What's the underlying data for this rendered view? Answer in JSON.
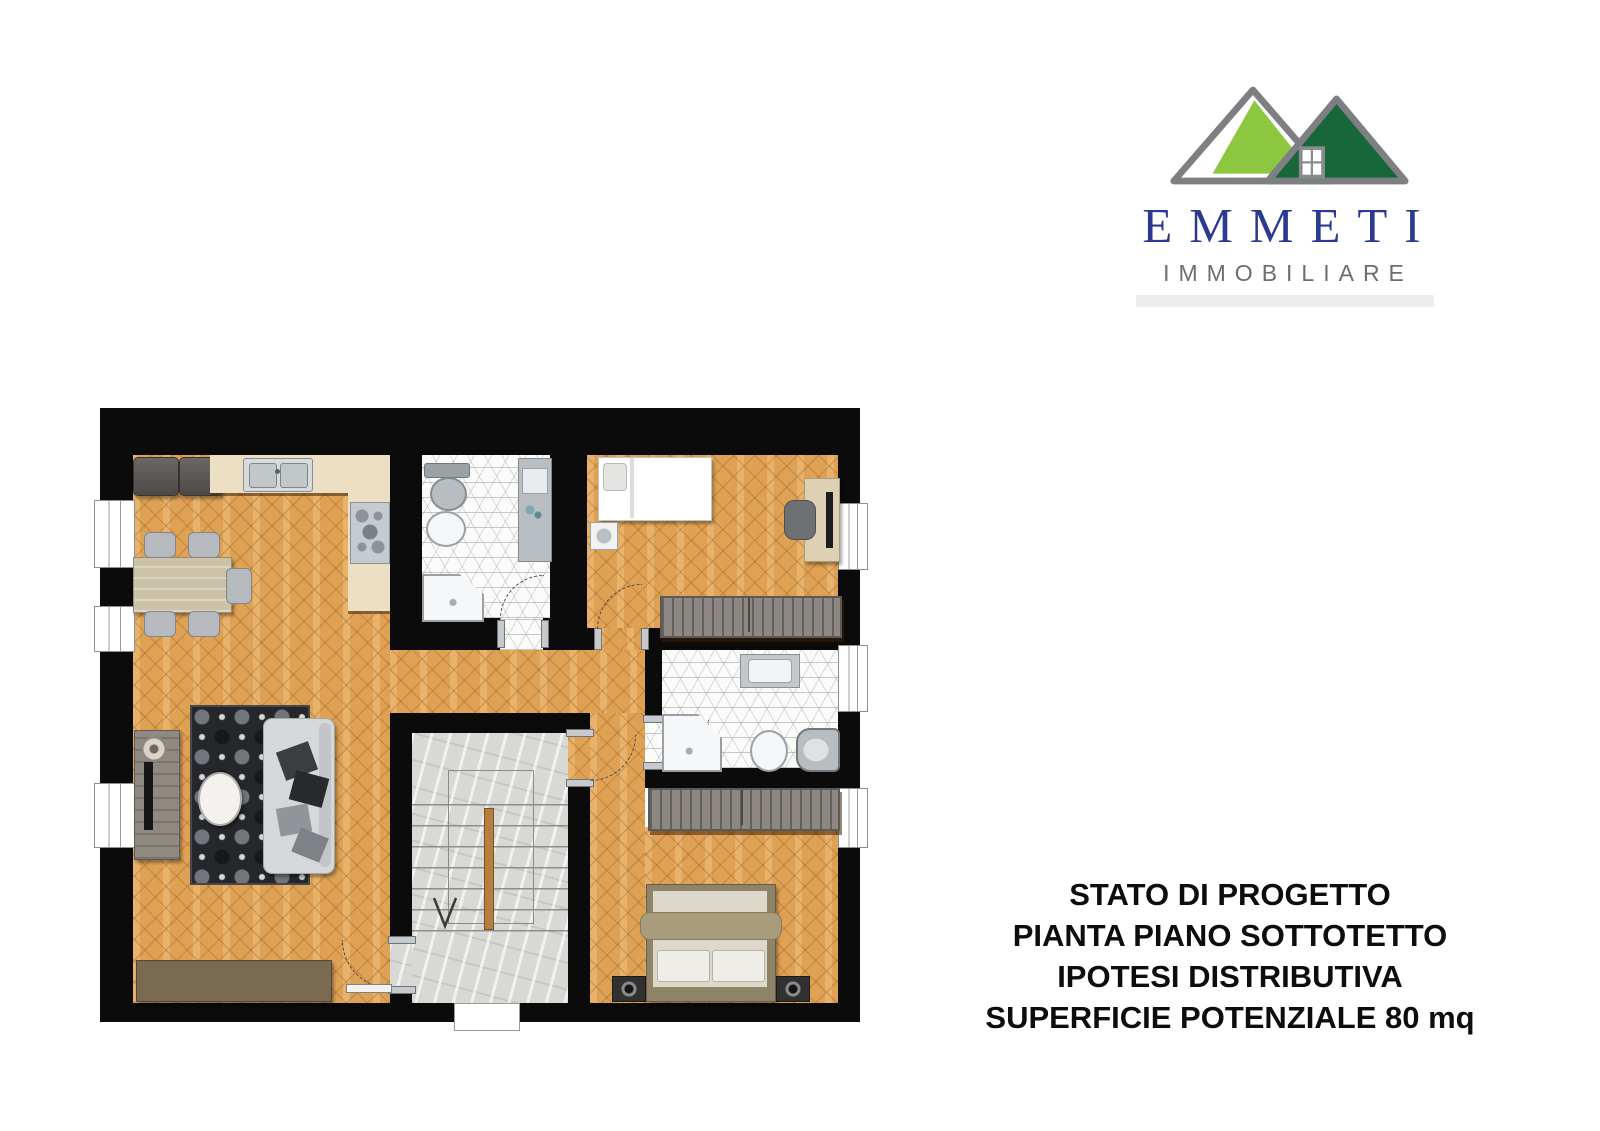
{
  "logo": {
    "name": "EMMETI",
    "subtitle": "IMMOBILIARE",
    "colors": {
      "roof_left": "#8dc63f",
      "roof_right": "#17673a",
      "roof_outline": "#7d7f82",
      "name_text": "#2b3990",
      "subtitle_text": "#6d6e71",
      "underline_bar": "#ededee"
    }
  },
  "caption": {
    "lines": [
      "STATO DI PROGETTO",
      "PIANTA PIANO SOTTOTETTO",
      "IPOTESI DISTRIBUTIVA",
      "SUPERFICIE POTENZIALE 80 mq"
    ],
    "color": "#0d0d0d"
  },
  "plan": {
    "colors": {
      "wall": "#0b0b0b",
      "parquet_floor": "#dfa255",
      "bathroom_tile": "#fbfbfa",
      "stair_marble": "#d8d8d5",
      "kitchen_counter": "#ecdfc4",
      "wardrobe": "#8d8883",
      "sideboard": "#7b6a52",
      "rug": "#26272a",
      "bed_frame": "#8f8468",
      "stair_rail": "#b5803f"
    }
  }
}
